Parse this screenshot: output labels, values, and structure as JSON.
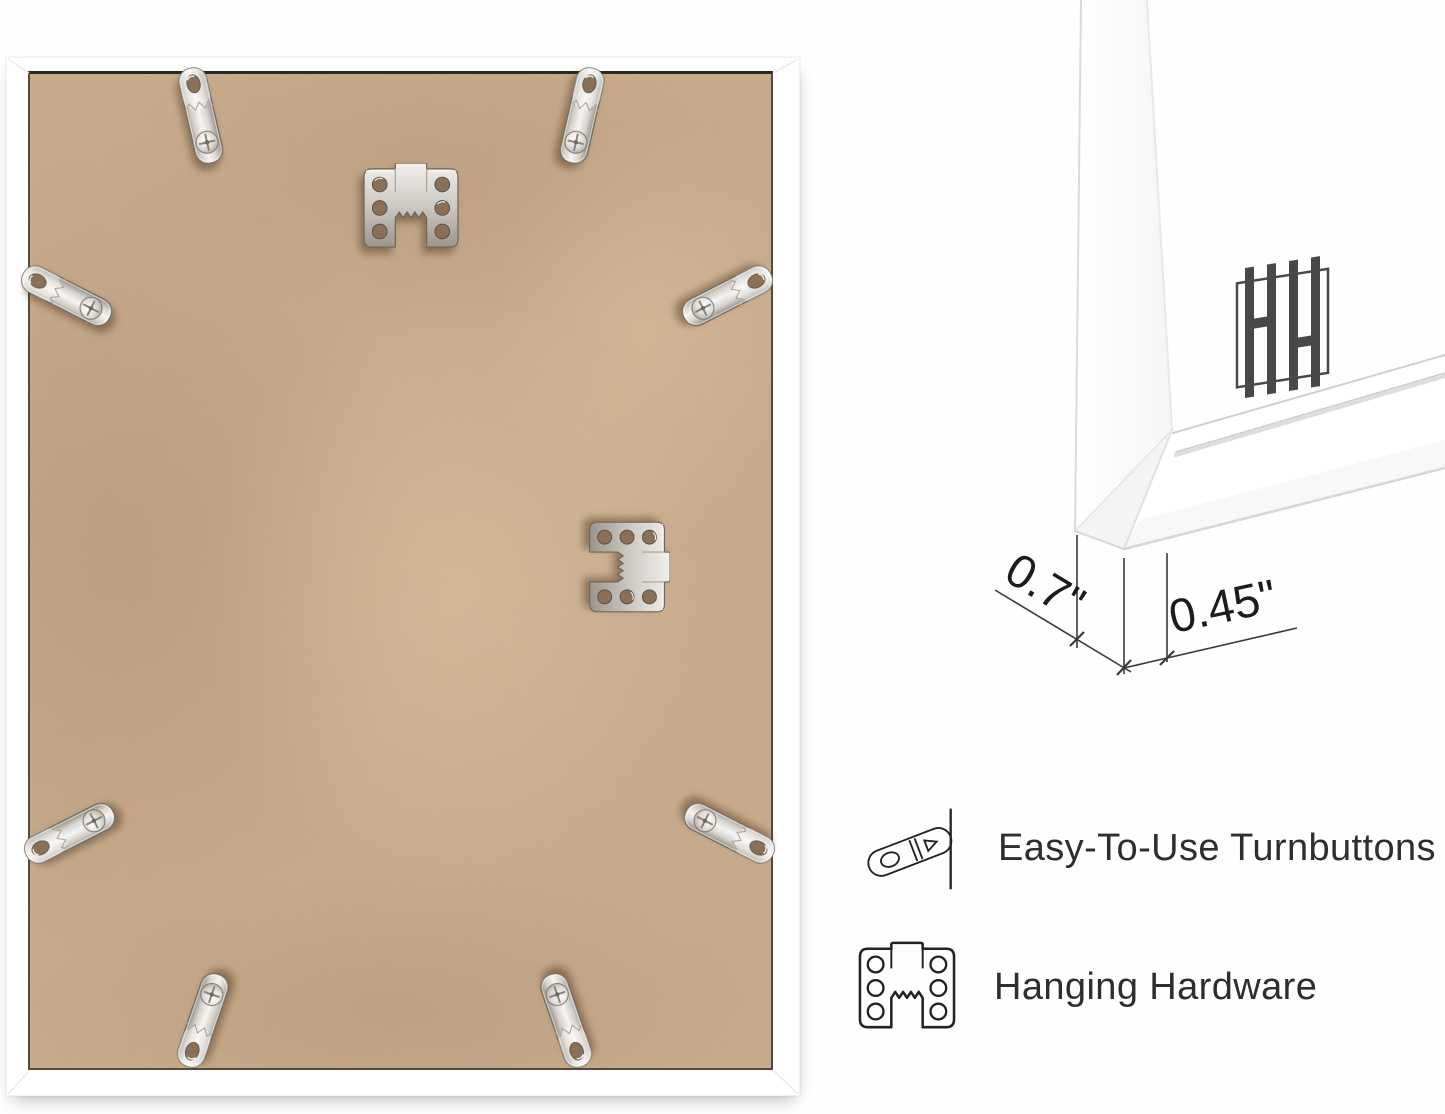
{
  "page": {
    "background": "#ffffff"
  },
  "photo": {
    "description": "back of white picture frame",
    "frame_color": "#ffffff",
    "backing_color": "#c3a384",
    "turnbutton_count": 8,
    "sawtooth_hanger_count": 2
  },
  "diagram": {
    "depth_label": "0.7\"",
    "face_label": "0.45\"",
    "line_color": "#3a3a3a",
    "logo_icon": "hh-brand-logo"
  },
  "features": [
    {
      "icon": "turnbutton-icon",
      "label": "Easy-To-Use Turnbuttons"
    },
    {
      "icon": "hanging-hardware-icon",
      "label": "Hanging Hardware"
    }
  ],
  "colors": {
    "metal": "#d8d5ce",
    "text": "#2e2e2e"
  }
}
